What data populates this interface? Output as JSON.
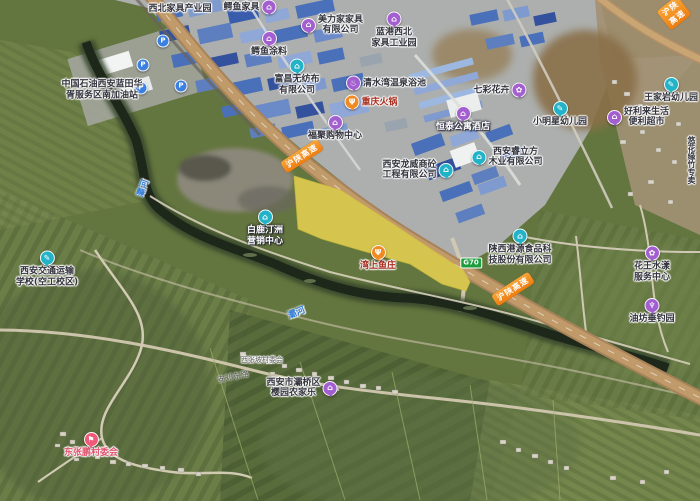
{
  "map_type": "satellite",
  "palette": {
    "highlight_polygon": "#f2e028",
    "expressway_banner_orange": "#ee7d10",
    "road_shield_green": "#1d9e3d",
    "poi_purple": "#a35fd0",
    "poi_teal": "#22b3c8",
    "poi_orange": "#f08a22",
    "poi_pink": "#ef5a78",
    "poi_blue": "#3b7fe0",
    "river_label_blue": "#3c82d8"
  },
  "icons": {
    "company": "⌂",
    "school": "✎",
    "food": "Ψ",
    "bath": "♨",
    "flower": "✿",
    "fishing": "♆",
    "flag": "⚑",
    "parking": "P"
  },
  "roads": {
    "expressway_name": "沪陕高速",
    "shield": "G70",
    "river_name": "灞河",
    "street_name": "安邓东路"
  },
  "pois": [
    {
      "id": "xibei-furniture-park",
      "label": "西北家具产业园"
    },
    {
      "id": "eyu-furniture",
      "label": "鳄鱼家具"
    },
    {
      "id": "meilijia-furniture",
      "l1": "美力家家具",
      "l2": "有限公司"
    },
    {
      "id": "langang-furniture-park",
      "l1": "蓝港西北",
      "l2": "家具工业园"
    },
    {
      "id": "eyu-paint",
      "label": "鳄鱼涂料"
    },
    {
      "id": "fuchang-nonwoven",
      "l1": "富昌无纺布",
      "l2": "有限公司"
    },
    {
      "id": "qingshuiwan-bath",
      "label": "清水湾温泉浴池"
    },
    {
      "id": "chongqing-hotpot",
      "label": "重庆火锅"
    },
    {
      "id": "fuju-mall",
      "label": "福聚购物中心"
    },
    {
      "id": "hengtai-hotel",
      "label": "恒泰公寓酒店"
    },
    {
      "id": "qicai-flowers",
      "label": "七彩花卉"
    },
    {
      "id": "xiaomingxing-kindergarten",
      "label": "小明星幼儿园"
    },
    {
      "id": "wangjiayan-kindergarten",
      "label": "王家岩幼儿园"
    },
    {
      "id": "haolilai-store",
      "l1": "好利来生活",
      "l2": "便利超市"
    },
    {
      "id": "longwei-engineering",
      "l1": "西安龙威商砼",
      "l2": "工程有限公司"
    },
    {
      "id": "ruilifang-wood",
      "l1": "西安睿立方",
      "l2": "木业有限公司"
    },
    {
      "id": "bailutingzhou-center",
      "l1": "白鹿汀洲",
      "l2": "营销中心"
    },
    {
      "id": "wanshang-fish",
      "label": "湾上鱼庄"
    },
    {
      "id": "gangyuan-food",
      "l1": "陕西港源食品科",
      "l2": "技股份有限公司"
    },
    {
      "id": "huawang-service",
      "l1": "花王水漾",
      "l2": "服务中心"
    },
    {
      "id": "youfang-fishing",
      "label": "油坊垂钓园"
    },
    {
      "id": "youhuayuan-bamboo",
      "label": "悠花缘竹专卖"
    },
    {
      "id": "jiaotong-school",
      "l1": "西安交通运输",
      "l2": "学校(空工校区)"
    },
    {
      "id": "dongzhangpeng-committee",
      "label": "东张鹏村委会"
    },
    {
      "id": "yingyuan-farmstay",
      "l1": "西安市灞桥区",
      "l2": "樱园农家乐"
    },
    {
      "id": "xizhangpo-committee",
      "label": "西张坡村委会"
    },
    {
      "id": "petrochina-gas",
      "l1": "中国石油西安蓝田华",
      "l2": "胥服务区南加油站"
    }
  ]
}
